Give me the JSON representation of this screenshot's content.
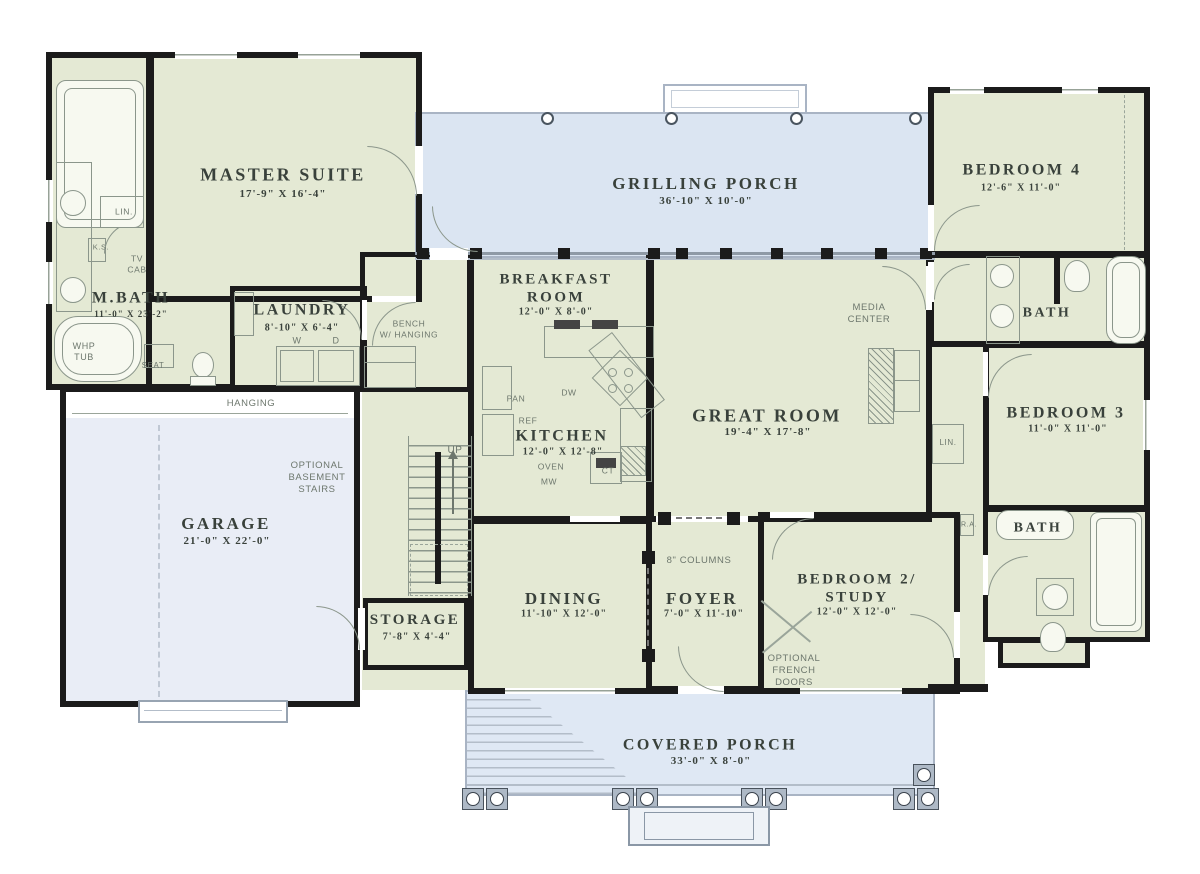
{
  "palette": {
    "room_fill": "#e4e9d4",
    "porch_fill": "#dbe5f2",
    "cporch_fill": "#dfe8f4",
    "garage_fill": "#e9edf6",
    "wall": "#1b1b1b",
    "ink": "#39413b",
    "ann": "#6d776d",
    "fixture": "#8b968b",
    "porch_line": "#a9b4c4"
  },
  "rooms": {
    "master_suite": {
      "name": "MASTER SUITE",
      "dims": "17'-9\" X 16'-4\""
    },
    "m_bath": {
      "name": "M.BATH",
      "dims": "11'-0\" X 23'-2\""
    },
    "laundry": {
      "name": "LAUNDRY",
      "dims": "8'-10\" X 6'-4\""
    },
    "grilling_porch": {
      "name": "GRILLING PORCH",
      "dims": "36'-10\" X 10'-0\""
    },
    "bedroom_4": {
      "name": "BEDROOM 4",
      "dims": "12'-6\" X 11'-0\""
    },
    "bath_4": {
      "name": "BATH"
    },
    "breakfast_room": {
      "name": "BREAKFAST\nROOM",
      "dims": "12'-0\" X 8'-0\""
    },
    "kitchen": {
      "name": "KITCHEN",
      "dims": "12'-0\" X 12'-8\""
    },
    "great_room": {
      "name": "GREAT ROOM",
      "dims": "19'-4\" X 17'-8\""
    },
    "bedroom_3": {
      "name": "BEDROOM 3",
      "dims": "11'-0\" X 11'-0\""
    },
    "bath_3": {
      "name": "BATH"
    },
    "garage": {
      "name": "GARAGE",
      "dims": "21'-0\" X 22'-0\""
    },
    "storage": {
      "name": "STORAGE",
      "dims": "7'-8\" X 4'-4\""
    },
    "dining": {
      "name": "DINING",
      "dims": "11'-10\" X 12'-0\""
    },
    "foyer": {
      "name": "FOYER",
      "dims": "7'-0\" X 11'-10\""
    },
    "bedroom_2": {
      "name": "BEDROOM 2/\nSTUDY",
      "dims": "12'-0\" X 12'-0\""
    },
    "covered_porch": {
      "name": "COVERED PORCH",
      "dims": "33'-0\" X 8'-0\""
    }
  },
  "annotations": {
    "whp_tub": "WHP\nTUB",
    "seat": "SEAT",
    "lin_master": "LIN.",
    "ks": "K.S.",
    "tv_cab": "TV\nCAB",
    "hanging": "HANGING",
    "bench": "BENCH\nW/ HANGING",
    "optional_basement": "OPTIONAL\nBASEMENT\nSTAIRS",
    "up": "UP",
    "pan": "PAN",
    "ref": "REF",
    "dw": "DW",
    "oven": "OVEN",
    "mw": "MW",
    "ct": "CT",
    "washer": "W",
    "dryer": "D",
    "media_center": "MEDIA\nCENTER",
    "lin_hall": "LIN.",
    "columns": "8\" COLUMNS",
    "ra": "R.A.",
    "optional_french": "OPTIONAL\nFRENCH\nDOORS"
  }
}
